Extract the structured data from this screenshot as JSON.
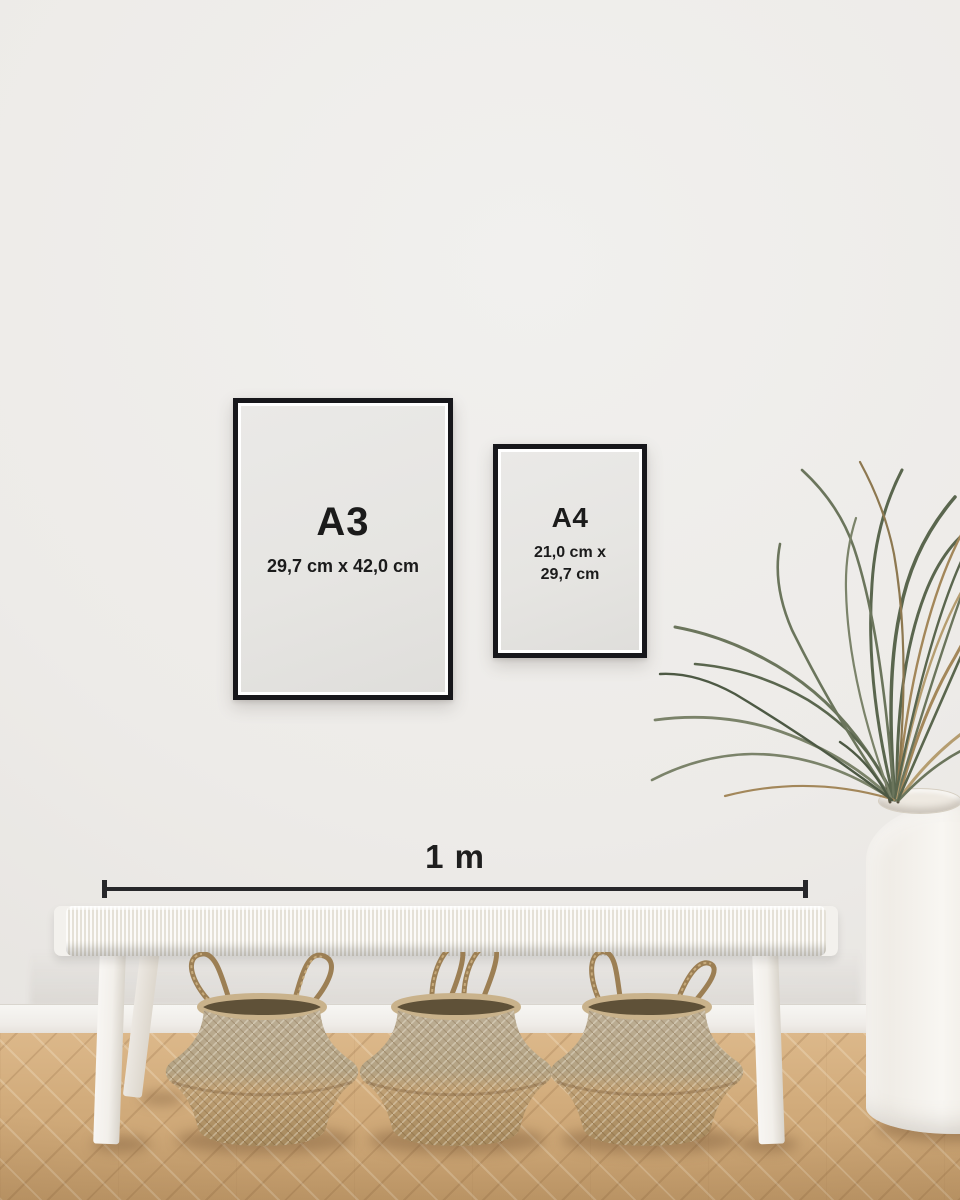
{
  "frames": {
    "a3": {
      "label": "A3",
      "dims": "29,7 cm x 42,0 cm"
    },
    "a4": {
      "label": "A4",
      "dims_line1": "21,0 cm x",
      "dims_line2": "29,7 cm"
    }
  },
  "ruler": {
    "label": "1 m"
  },
  "colors": {
    "frame_border": "#17171b",
    "text": "#1b1b1b",
    "wall": "#edebe8",
    "paper": "#e6e5e2",
    "floor_wood": "#d2ac7c",
    "basket_tan": "#b5a182",
    "bench_white": "#f3f1ed",
    "plant_green": "#657056",
    "plant_brown": "#a98c5f"
  }
}
